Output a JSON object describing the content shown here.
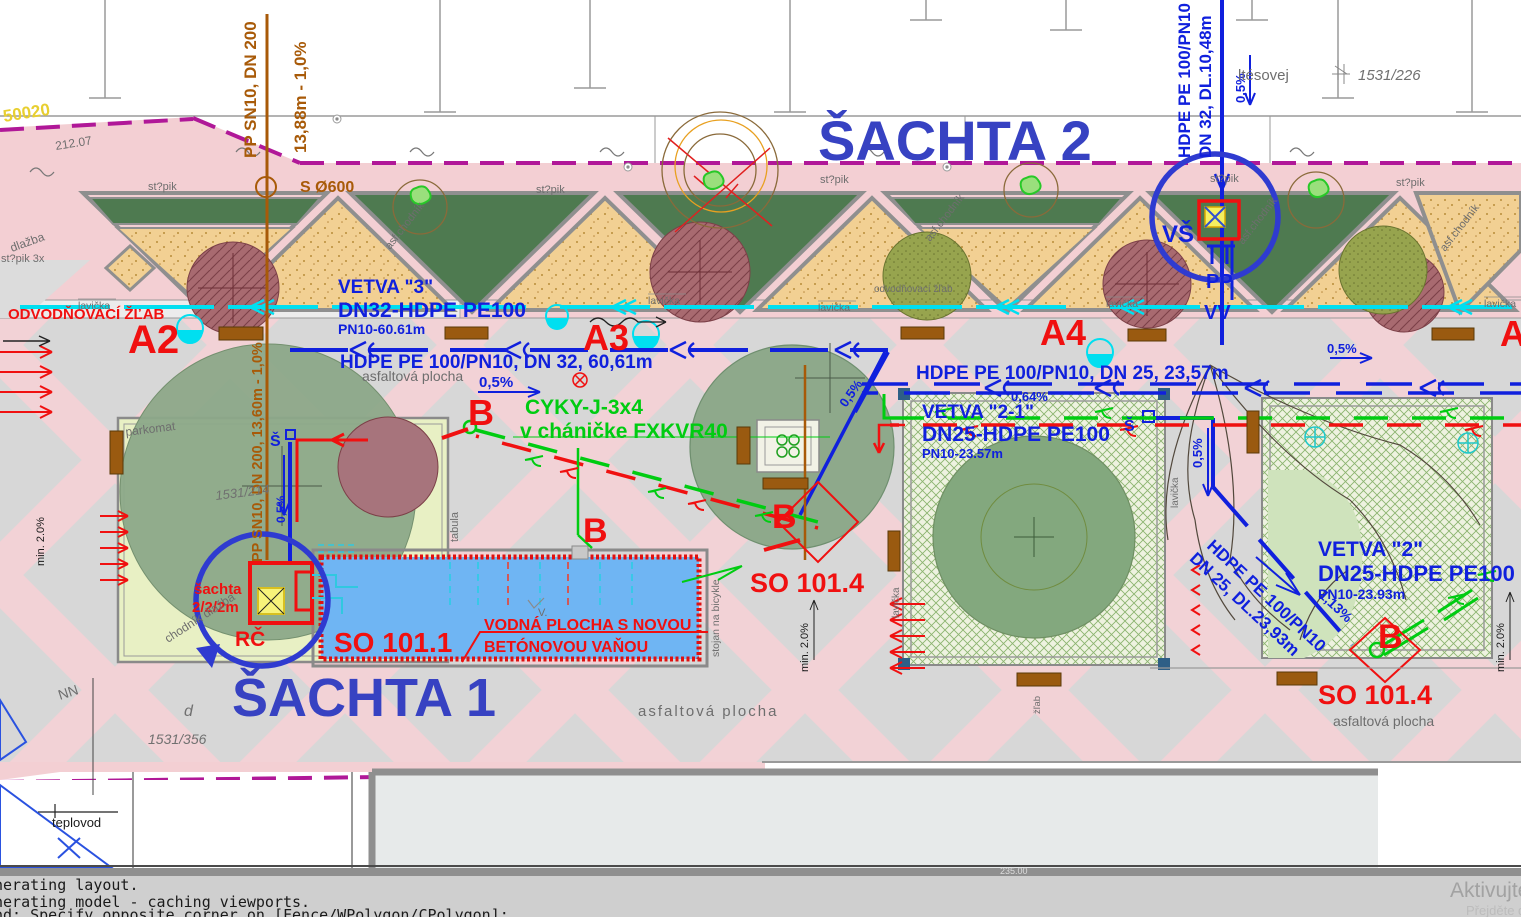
{
  "titles": {
    "shaft2": "ŠACHTA 2",
    "shaft1": "ŠACHTA 1"
  },
  "red": {
    "a2": "A2",
    "a3": "A3",
    "a4": "A4",
    "a_edge": "A",
    "b": "B",
    "so101_1": "SO 101.1",
    "so101_4": "SO 101.4",
    "drain": "ODVODŇOVACÍ ŽĽAB",
    "rc": "RČ",
    "shaft_small_1": "šachta",
    "shaft_small_2": "2/2/2m",
    "pool_note_1": "VODNÁ PLOCHA S NOVOU",
    "pool_note_2": "BETÓNOVOU VAŇOU"
  },
  "blue": {
    "vetva3": "VETVA \"3\"",
    "vetva3_pipe": "DN32-HDPE PE100",
    "vetva3_pn": "PN10-60.61m",
    "dn32_run": "HDPE PE 100/PN10, DN 32, 60,61m",
    "slope05": "0,5%",
    "slope064": "0,64%",
    "slope113": "1,13%",
    "dn25_run": "HDPE PE 100/PN10, DN 25, 23,57m",
    "vetva21": "VETVA \"2-1\"",
    "vetva21_pipe": "DN25-HDPE PE100",
    "vetva21_pn": "PN10-23.57m",
    "vetva2": "VETVA \"2\"",
    "vetva2_pipe": "DN25-HDPE PE100",
    "vetva2_pn": "PN10-23.93m",
    "riser_1": "HDPE PE 100/PN10",
    "riser_2": "DN 32, DL.10,48m",
    "diag_1": "HDPE PE 100/PN10",
    "diag_2": "DN 25, DL.23,93m",
    "vs": "VŠ",
    "pp": "PP",
    "vv": "VV",
    "s_shaft": "Š"
  },
  "green": {
    "cable1": "CYKY-J-3x4",
    "cable2": "v cháničke FXKVR40"
  },
  "brown": {
    "sewer1": "PP SN10, DN 200",
    "sewer2": "13,88m - 1,0%",
    "manhole": "S Ø600",
    "sewer3": "PP SN10, DN 200, 13,60m - 1,0%"
  },
  "gray": {
    "stlpik": "st?pik",
    "stlpik3": "st?pik  3x",
    "dlazba": "dlažba",
    "asf_chodnik": "asf.chodník",
    "lavicka": "lavička",
    "odvod_small": "odvodňovací  žľab",
    "asfalt": "asfaltová plocha",
    "parkomat": "parkomat",
    "tabula": "tabula",
    "stojan": "stojan na bicykle",
    "chodnik_dlazba": "chodník dlažba",
    "zlab": "žľab",
    "parcel_226": "1531/226",
    "parcel_214": "1531/214",
    "parcel_356": "1531/356",
    "elev": "212.07",
    "d": "d",
    "nn": "NN",
    "teplovod": "teplovod",
    "street": "ltésovej",
    "v": "V.",
    "dim235": "235.00",
    "min20": "min. 2.0%"
  },
  "yellow": {
    "code": "50020"
  },
  "command": {
    "line1": "nerating layout.",
    "line2": "nerating model - caching viewports.",
    "line3": "nd: Specify opposite corner on [Fence/WPolygon/CPolygon]:"
  },
  "watermark": {
    "line1": "Aktivujte",
    "line2": "Přejděte do"
  },
  "colors": {
    "pipe_blue": "#1020dd",
    "cad_red": "#f01010",
    "cable_green": "#00cc11",
    "drain_cyan": "#00dff0",
    "sewer_brown": "#a85a08",
    "boundary_magenta": "#b01898",
    "title_blue": "#3742c2"
  }
}
